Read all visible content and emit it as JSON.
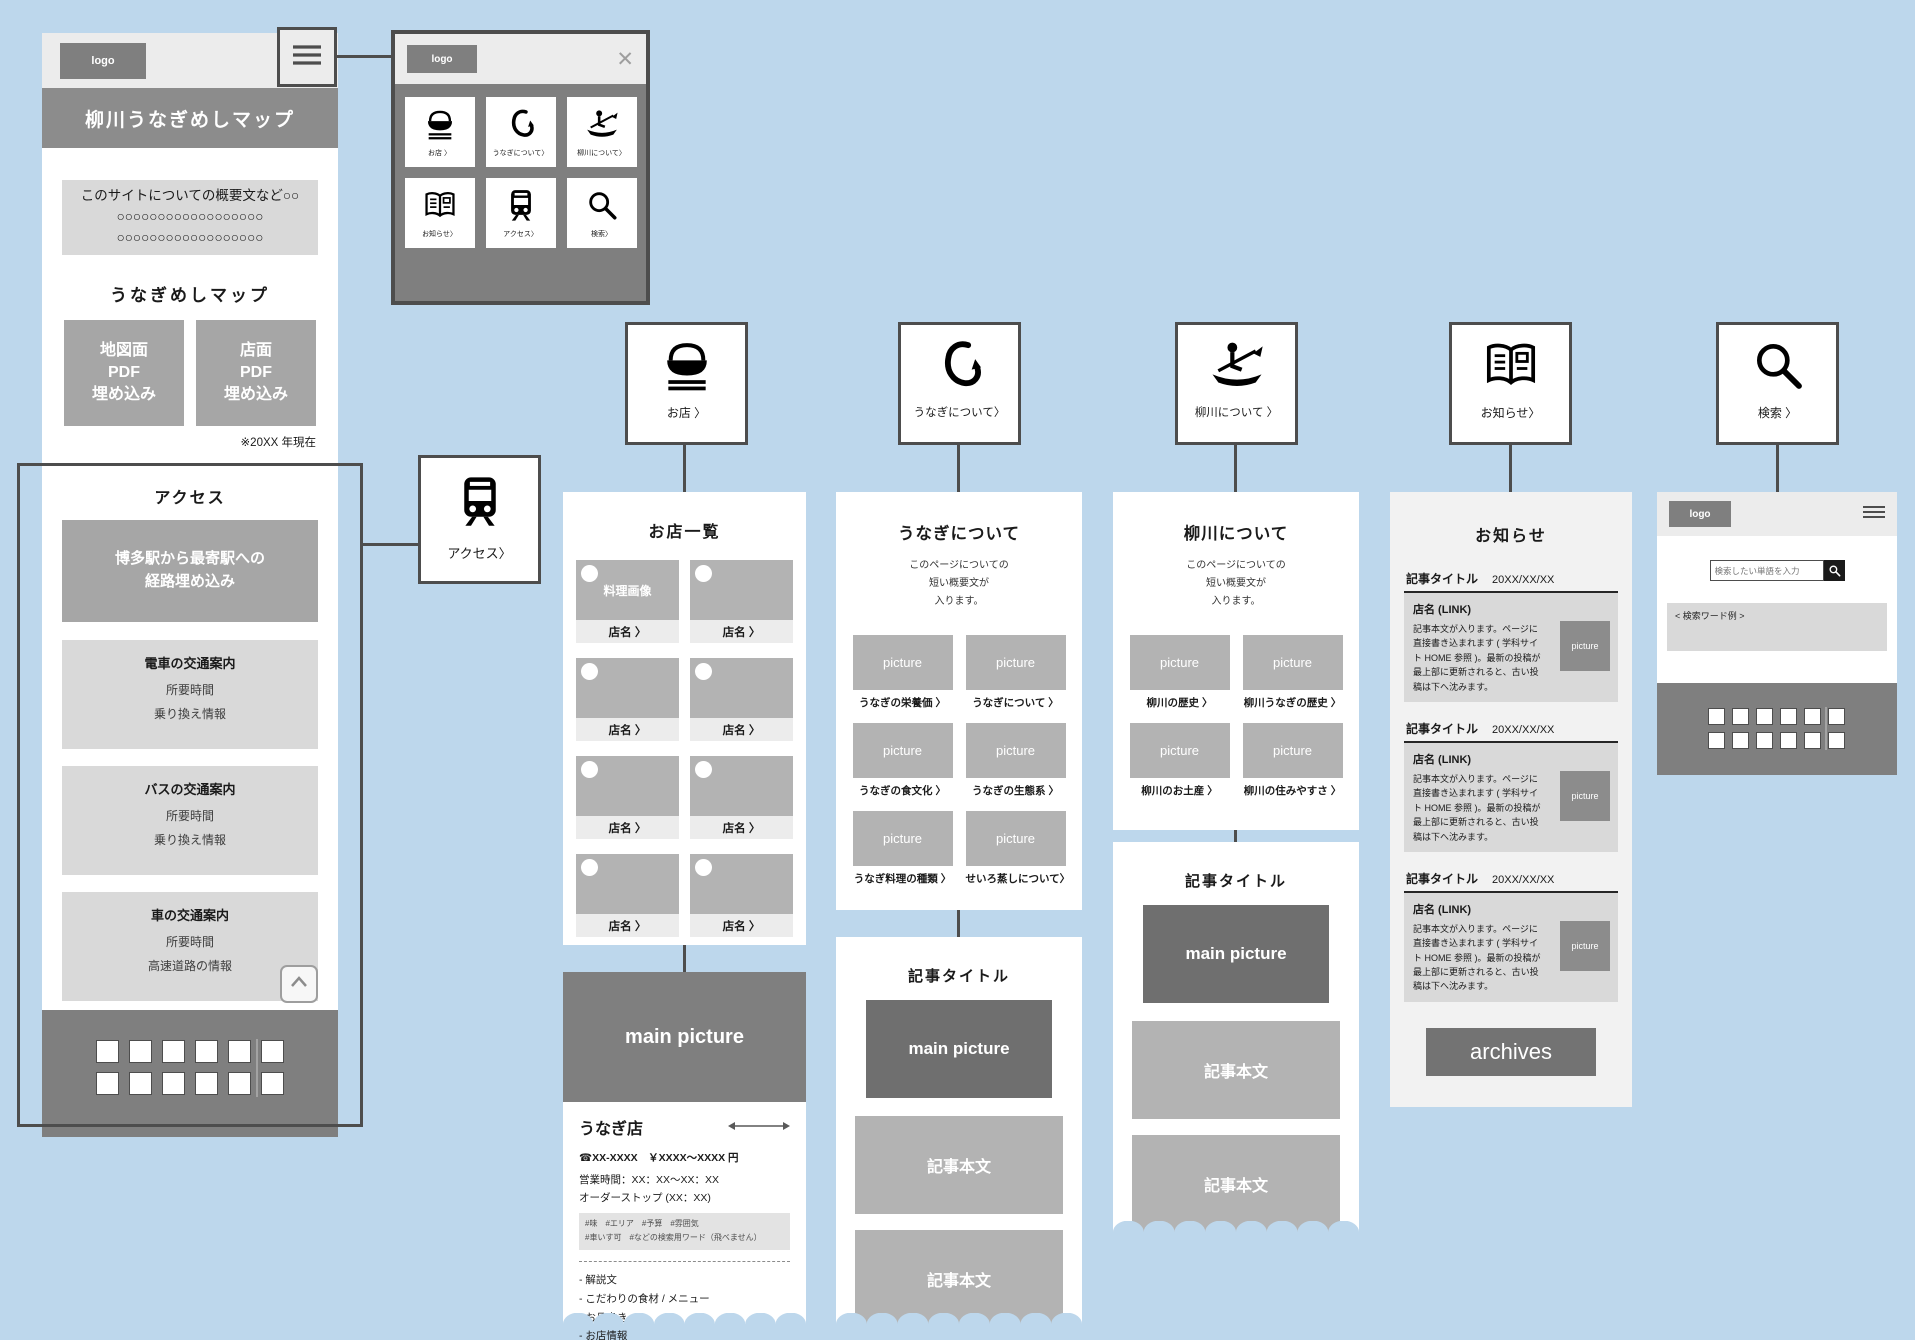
{
  "colors": {
    "background": "#bdd7ec",
    "dark_gray": "#7f7f7f",
    "mid_gray": "#a6a6a6",
    "light_gray": "#d9d9d9",
    "outline": "#4d4d4d"
  },
  "home": {
    "logo": "logo",
    "title": "柳川うなぎめしマップ",
    "concept": {
      "line1": "このサイトについての概要文など○○",
      "line2": "○○○○○○○○○○○○○○○○○○",
      "line3": "○○○○○○○○○○○○○○○○○○"
    },
    "map_heading": "うなぎめしマップ",
    "map_button1": {
      "line1": "地図面",
      "line2": "PDF",
      "line3": "埋め込み"
    },
    "map_button2": {
      "line1": "店面",
      "line2": "PDF",
      "line3": "埋め込み"
    },
    "note": "※20XX 年現在",
    "access_heading": "アクセス",
    "route_line1": "博多駅から最寄駅への",
    "route_line2": "経路埋め込み",
    "access_cards": [
      {
        "title": "電車の交通案内",
        "line1": "所要時間",
        "line2": "乗り換え情報"
      },
      {
        "title": "バスの交通案内",
        "line1": "所要時間",
        "line2": "乗り換え情報"
      },
      {
        "title": "車の交通案内",
        "line1": "所要時間",
        "line2": "高速道路の情報"
      }
    ]
  },
  "menu_popup": {
    "logo": "logo",
    "close": "✕",
    "items": [
      {
        "icon": "rice-bowl-icon",
        "label": "お店 〉"
      },
      {
        "icon": "fishhook-icon",
        "label": "うなぎについて〉"
      },
      {
        "icon": "rowing-icon",
        "label": "柳川について〉"
      },
      {
        "icon": "book-icon",
        "label": "お知らせ〉"
      },
      {
        "icon": "train-icon",
        "label": "アクセス〉"
      },
      {
        "icon": "search-icon",
        "label": "検索〉"
      }
    ]
  },
  "access_card": {
    "icon": "train-icon",
    "label": "アクセス〉"
  },
  "section_cards": [
    {
      "icon": "rice-bowl-icon",
      "label": "お店 〉"
    },
    {
      "icon": "fishhook-icon",
      "label": "うなぎについて〉"
    },
    {
      "icon": "rowing-icon",
      "label": "柳川について 〉"
    },
    {
      "icon": "book-icon",
      "label": "お知らせ〉"
    },
    {
      "icon": "search-icon",
      "label": "検索 〉"
    }
  ],
  "shop_list": {
    "title": "お店一覧",
    "first_tile_caption": "料理画像",
    "items": [
      {
        "label": "店名 〉"
      },
      {
        "label": "店名 〉"
      },
      {
        "label": "店名 〉"
      },
      {
        "label": "店名 〉"
      },
      {
        "label": "店名 〉"
      },
      {
        "label": "店名 〉"
      },
      {
        "label": "店名 〉"
      },
      {
        "label": "店名 〉"
      }
    ]
  },
  "shop_detail": {
    "main_picture": "main picture",
    "name": "うなぎ店",
    "tel_price": "☎XX-XXXX　￥XXXX〜XXXX 円",
    "hours": "営業時間：XX：XX〜XX：XX",
    "order_stop": "オーダーストップ (XX：XX)",
    "tags_line1": "#味　#エリア　#予算　#雰囲気",
    "tags_line2": "#車いす可　#などの検索用ワード（飛べません）",
    "list": [
      "- 解説文",
      "- こだわりの食材 / メニュー",
      "- お品書き",
      "- お店情報"
    ]
  },
  "unagi_page": {
    "title": "うなぎについて",
    "intro": [
      "このページについての",
      "短い概要文が",
      "入ります。"
    ],
    "tiles": [
      {
        "picture": "picture",
        "label": "うなぎの栄養価 〉"
      },
      {
        "picture": "picture",
        "label": "うなぎについて 〉"
      },
      {
        "picture": "picture",
        "label": "うなぎの食文化 〉"
      },
      {
        "picture": "picture",
        "label": "うなぎの生態系 〉"
      },
      {
        "picture": "picture",
        "label": "うなぎ料理の種類 〉"
      },
      {
        "picture": "picture",
        "label": "せいろ蒸しについて〉"
      }
    ]
  },
  "yanagawa_page": {
    "title": "柳川について",
    "intro": [
      "このページについての",
      "短い概要文が",
      "入ります。"
    ],
    "tiles": [
      {
        "picture": "picture",
        "label": "柳川の歴史 〉"
      },
      {
        "picture": "picture",
        "label": "柳川うなぎの歴史 〉"
      },
      {
        "picture": "picture",
        "label": "柳川のお土産 〉"
      },
      {
        "picture": "picture",
        "label": "柳川の住みやすさ 〉"
      }
    ]
  },
  "article_page": {
    "title": "記事タイトル",
    "main_picture": "main picture",
    "body1": "記事本文",
    "body2": "記事本文"
  },
  "news_page": {
    "title": "お知らせ",
    "articles": [
      {
        "title": "記事タイトル",
        "date": "20XX/XX/XX",
        "link": "店名 (LINK)",
        "body": "記事本文が入ります。ページに直接書き込まれます ( 学科サイト HOME 参照 )。最新の投稿が最上部に更新されると、古い投稿は下へ沈みます。",
        "picture": "picture"
      },
      {
        "title": "記事タイトル",
        "date": "20XX/XX/XX",
        "link": "店名 (LINK)",
        "body": "記事本文が入ります。ページに直接書き込まれます ( 学科サイト HOME 参照 )。最新の投稿が最上部に更新されると、古い投稿は下へ沈みます。",
        "picture": "picture"
      },
      {
        "title": "記事タイトル",
        "date": "20XX/XX/XX",
        "link": "店名 (LINK)",
        "body": "記事本文が入ります。ページに直接書き込まれます ( 学科サイト HOME 参照 )。最新の投稿が最上部に更新されると、古い投稿は下へ沈みます。",
        "picture": "picture"
      }
    ],
    "archives_label": "archives"
  },
  "search_page": {
    "logo": "logo",
    "placeholder": "検索したい単語を入力",
    "keyword_example": "< 検索ワード例 >"
  }
}
